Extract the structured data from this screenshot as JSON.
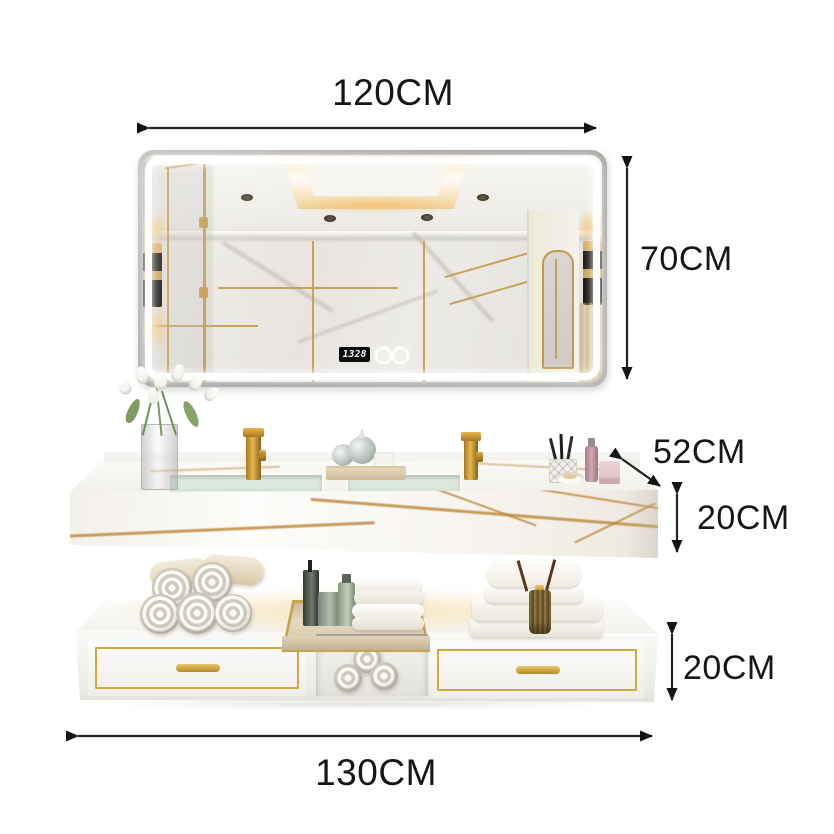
{
  "annotations": {
    "mirror_width": "120CM",
    "mirror_height": "70CM",
    "counter_depth": "52CM",
    "counter_height": "20CM",
    "cabinet_height": "20CM",
    "cabinet_width": "130CM"
  },
  "mirror": {
    "clock_time": "1328"
  },
  "icons": {
    "dimension_arrow": "double-headed-arrow",
    "clock": "digital-clock-display",
    "touch_button": "circular-touch-sensor",
    "downlight": "recessed-ceiling-light",
    "sconce": "wall-lamp"
  },
  "colors": {
    "annotation_text": "#161616",
    "arrow": "#1c1c1c",
    "gold_accent": "#c9a44d",
    "marble_vein_gold": "#c08a3e",
    "led_glow": "#ffffff",
    "towel_cream": "#dec9a4",
    "tassel_bronze": "#7a6336"
  }
}
